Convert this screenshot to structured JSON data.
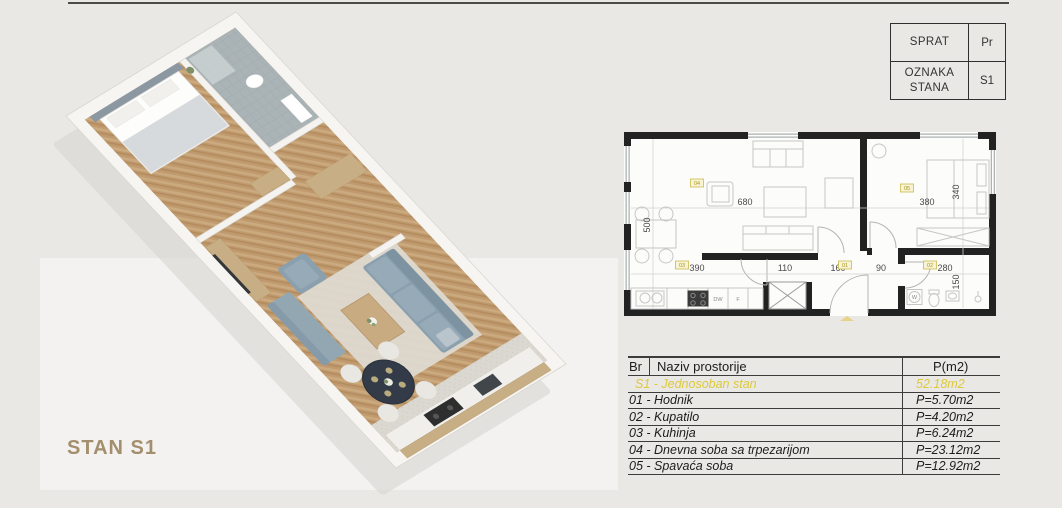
{
  "title": {
    "label": "STAN S1"
  },
  "info_table": {
    "rows": [
      {
        "label": "SPRAT",
        "value": "Pr"
      },
      {
        "label": "OZNAKA STANA",
        "value": "S1"
      }
    ]
  },
  "plan2d": {
    "dims": {
      "living_w": "680",
      "living_h": "500",
      "bedroom_w": "380",
      "bedroom_h": "340",
      "kitchen_w": "390",
      "hall_a": "110",
      "hall_b": "160",
      "hall_c": "90",
      "bath_w": "280",
      "bath_h": "150"
    },
    "tags": {
      "hallway": "01",
      "bathroom": "02",
      "kitchen": "03",
      "living": "04",
      "bedroom": "05"
    },
    "appliances": {
      "dishwasher": "DW",
      "fridge": "F",
      "washer": "W"
    }
  },
  "areas_table": {
    "headers": {
      "br": "Br",
      "name": "Naziv prostorije",
      "area": "P(m2)"
    },
    "summary": {
      "name": "S1 - Jednosoban stan",
      "area": "52.18m2"
    },
    "rows": [
      {
        "name": "01 - Hodnik",
        "area": "P=5.70m2"
      },
      {
        "name": "02 - Kupatilo",
        "area": "P=4.20m2"
      },
      {
        "name": "03 - Kuhinja",
        "area": "P=6.24m2"
      },
      {
        "name": "04 - Dnevna soba sa trpezarijom",
        "area": "P=23.12m2"
      },
      {
        "name": "05 - Spavaća soba",
        "area": "P=12.92m2"
      }
    ]
  },
  "colors": {
    "background": "#e9e8e5",
    "accent_yellow": "#ddc93a",
    "tag_yellow_fill": "#f8f3d2",
    "label_tan": "#a38f6d",
    "wall_black": "#222222",
    "wood": "#c09a6e",
    "sofa_blue": "#8ba0ae",
    "bath_tile": "#aab3b5"
  }
}
